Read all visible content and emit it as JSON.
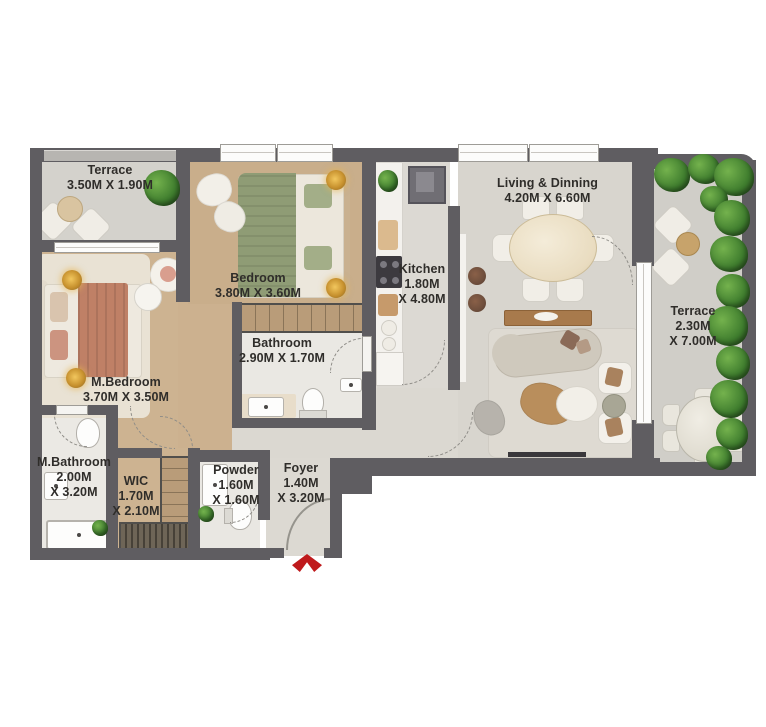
{
  "plan": {
    "colors": {
      "wall": "#5f5d61",
      "entrance_arrow": "#bf1a1c",
      "plant_green": "#3f7d2e",
      "wood_floor": "#c9ae8b",
      "living_floor": "#d8d5ce"
    },
    "rooms": {
      "terrace_tl": {
        "name": "Terrace",
        "dims": [
          "3.50M X 1.90M"
        ]
      },
      "bedroom": {
        "name": "Bedroom",
        "dims": [
          "3.80M X 3.60M"
        ]
      },
      "kitchen": {
        "name": "Kitchen",
        "dims": [
          "1.80M",
          "X 4.80M"
        ]
      },
      "living": {
        "name": "Living & Dinning",
        "dims": [
          "4.20M X 6.60M"
        ]
      },
      "terrace_r": {
        "name": "Terrace",
        "dims": [
          "2.30M",
          "X 7.00M"
        ]
      },
      "m_bedroom": {
        "name": "M.Bedroom",
        "dims": [
          "3.70M X 3.50M"
        ]
      },
      "bathroom": {
        "name": "Bathroom",
        "dims": [
          "2.90M X 1.70M"
        ]
      },
      "m_bathroom": {
        "name": "M.Bathroom",
        "dims": [
          "2.00M",
          "X 3.20M"
        ]
      },
      "wic": {
        "name": "WIC",
        "dims": [
          "1.70M",
          "X 2.10M"
        ]
      },
      "powder": {
        "name": "Powder",
        "dims": [
          "1.60M",
          "X 1.60M"
        ]
      },
      "foyer": {
        "name": "Foyer",
        "dims": [
          "1.40M",
          "X 3.20M"
        ]
      }
    }
  }
}
